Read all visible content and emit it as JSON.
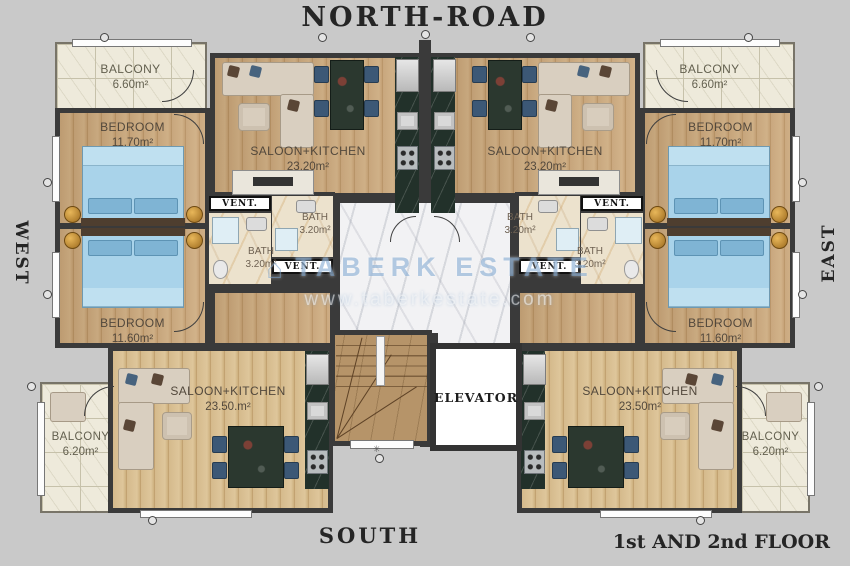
{
  "directions": {
    "north": "NORTH-ROAD",
    "south": "SOUTH",
    "west": "WEST",
    "east": "EAST"
  },
  "footer": {
    "floor_label": "1st AND 2nd FLOOR"
  },
  "watermark": {
    "brand": "TABERK ESTATE",
    "url": "www.taberkestate.com"
  },
  "core": {
    "elevator": "ELEVATOR"
  },
  "apartments": {
    "top_left": {
      "balcony": {
        "label": "BALCONY",
        "area": "6.60m²"
      },
      "bedroom": {
        "label": "BEDROOM",
        "area": "11.70m²"
      },
      "saloon": {
        "label": "SALOON+KITCHEN",
        "area": "23.20m²"
      },
      "bath": {
        "label": "BATH",
        "area": "3.20m²"
      },
      "vent": "VENT."
    },
    "top_right": {
      "balcony": {
        "label": "BALCONY",
        "area": "6.60m²"
      },
      "bedroom": {
        "label": "BEDROOM",
        "area": "11.70m²"
      },
      "saloon": {
        "label": "SALOON+KITCHEN",
        "area": "23.20m²"
      },
      "bath": {
        "label": "BATH",
        "area": "3.20m²"
      },
      "vent": "VENT."
    },
    "bottom_left": {
      "balcony": {
        "label": "BALCONY",
        "area": "6.20m²"
      },
      "bedroom": {
        "label": "BEDROOM",
        "area": "11.60m²"
      },
      "saloon": {
        "label": "SALOON+KITCHEN",
        "area": "23.50.m²"
      },
      "bath": {
        "label": "BATH",
        "area": "3.20m²"
      },
      "vent": "VENT."
    },
    "bottom_right": {
      "balcony": {
        "label": "BALCONY",
        "area": "6.20m²"
      },
      "bedroom": {
        "label": "BEDROOM",
        "area": "11.60m²"
      },
      "saloon": {
        "label": "SALOON+KITCHEN",
        "area": "23.50m²"
      },
      "bath": {
        "label": "BATH",
        "area": "3.20m²"
      },
      "vent": "VENT."
    }
  },
  "palette": {
    "wall": "#3a3a3a",
    "wood": "#c9a77a",
    "tile": "#eeeadb",
    "bath_marble": "#ece2cd",
    "corridor_marble": "#f2f2f4",
    "stair_marble": "#b69469",
    "kitchen_marble": "#22312a",
    "bed_blue": "#a9d3ea",
    "sofa_beige": "#d9cfc0",
    "chair_navy": "#3c5876",
    "gold": "#c8922f",
    "background": "#c9c9c9",
    "watermark_blue": "#7da5cd"
  }
}
